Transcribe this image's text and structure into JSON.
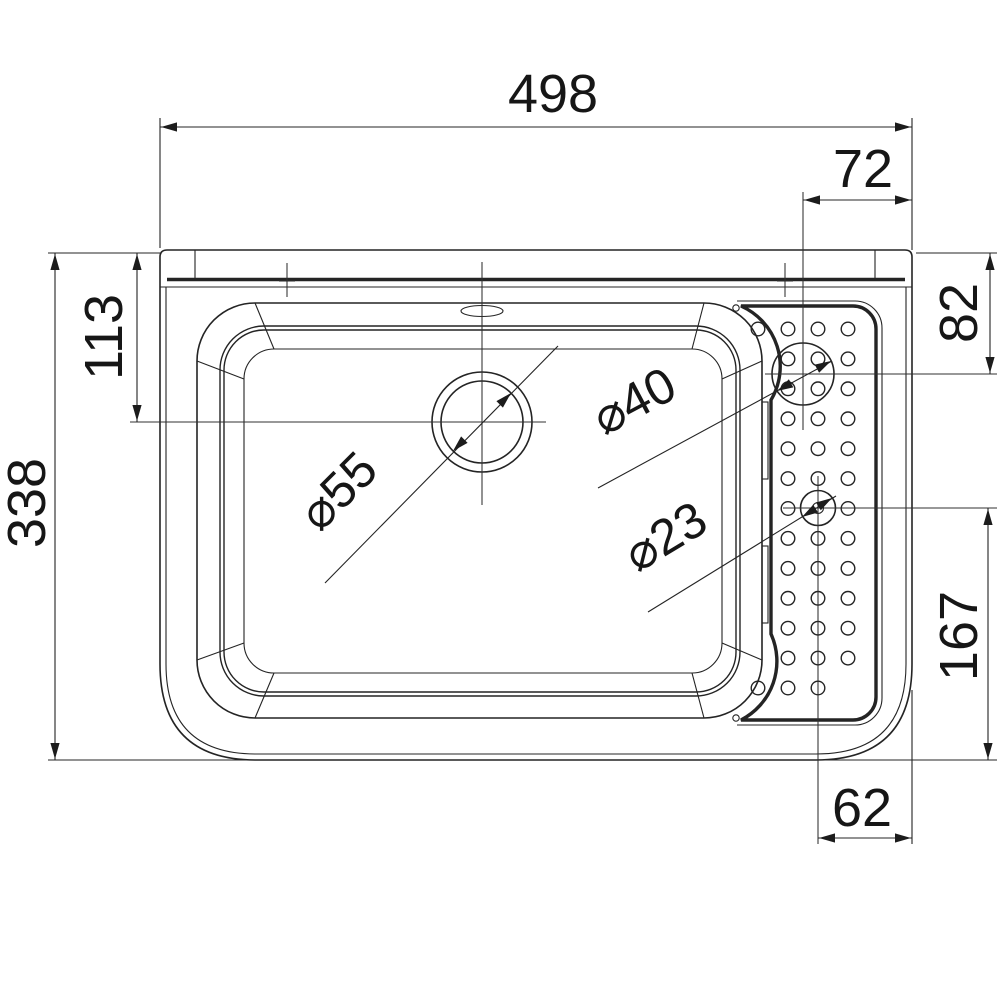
{
  "document": {
    "type": "technical-drawing",
    "subject": "sink-top-view",
    "units": "mm"
  },
  "page": {
    "background": "#ffffff",
    "ink": "#242424",
    "text_color": "#161616"
  },
  "dimensions": [
    {
      "label": "498",
      "value": 498,
      "axis": "h",
      "line": {
        "x1": 160,
        "x2": 912,
        "y": 127
      },
      "text": {
        "x": 553,
        "y": 112,
        "rot": 0
      },
      "ext": [
        [
          160,
          118,
          160,
          248
        ],
        [
          912,
          118,
          912,
          250
        ]
      ]
    },
    {
      "label": "72",
      "value": 72,
      "axis": "h",
      "line": {
        "x1": 803,
        "x2": 912,
        "y": 200
      },
      "text": {
        "x": 863,
        "y": 187,
        "rot": 0
      },
      "ext": []
    },
    {
      "label": "82",
      "value": 82,
      "axis": "v",
      "line": {
        "x": 990,
        "y1": 253,
        "y2": 374
      },
      "text": {
        "x": 977,
        "y": 313,
        "rot": -90
      },
      "ext": [
        [
          916,
          253,
          997,
          253
        ]
      ]
    },
    {
      "label": "113",
      "value": 113,
      "axis": "v",
      "line": {
        "x": 137,
        "y1": 253,
        "y2": 422
      },
      "text": {
        "x": 122,
        "y": 337,
        "rot": -90
      },
      "ext": [
        [
          48,
          253,
          160,
          253
        ]
      ]
    },
    {
      "label": "338",
      "value": 338,
      "axis": "v",
      "line": {
        "x": 55,
        "y1": 253,
        "y2": 760
      },
      "text": {
        "x": 45,
        "y": 503,
        "rot": -90
      },
      "ext": [
        [
          48,
          760,
          258,
          760
        ]
      ]
    },
    {
      "label": "167",
      "value": 167,
      "axis": "v",
      "line": {
        "x": 988,
        "y1": 508,
        "y2": 760
      },
      "text": {
        "x": 977,
        "y": 636,
        "rot": -90
      },
      "ext": [
        [
          820,
          760,
          997,
          760
        ]
      ]
    },
    {
      "label": "62",
      "value": 62,
      "axis": "h",
      "line": {
        "x1": 818,
        "x2": 912,
        "y": 838
      },
      "text": {
        "x": 862,
        "y": 826,
        "rot": 0
      },
      "ext": [
        [
          912,
          690,
          912,
          844
        ]
      ]
    }
  ],
  "leaders": [
    {
      "label": "⌀55",
      "value": 55,
      "line": [
        325,
        583,
        558,
        346
      ],
      "tips": [
        [
          453,
          451,
          135
        ],
        [
          511,
          393,
          -45
        ]
      ],
      "text": {
        "x": 350,
        "y": 503,
        "rot": -45
      }
    },
    {
      "label": "⌀40",
      "value": 40,
      "line": [
        598,
        488,
        832,
        361
      ],
      "tips": [
        [
          777,
          391,
          151.5
        ],
        [
          831,
          361,
          -28.5
        ]
      ],
      "text": {
        "x": 642,
        "y": 416,
        "rot": -28
      }
    },
    {
      "label": "⌀23",
      "value": 23,
      "line": [
        648,
        612,
        836,
        496
      ],
      "tips": [
        [
          802,
          517,
          148.3
        ],
        [
          832,
          498,
          -31.7
        ]
      ],
      "text": {
        "x": 674,
        "y": 551,
        "rot": -31
      }
    }
  ],
  "centerlines": [
    [
      482,
      262,
      482,
      505
    ],
    [
      130,
      422,
      546,
      422
    ],
    [
      803,
      192,
      803,
      430
    ],
    [
      765,
      374,
      997,
      374
    ],
    [
      818,
      476,
      818,
      844
    ],
    [
      783,
      508,
      997,
      508
    ]
  ],
  "band_ticks": {
    "verticals": [
      [
        287,
        263,
        287,
        297
      ],
      [
        785,
        263,
        785,
        297
      ]
    ],
    "dashes": [
      [
        279,
        281,
        295,
        281
      ],
      [
        777,
        281,
        793,
        281
      ]
    ]
  },
  "holes": {
    "columns": [
      758,
      788,
      818,
      848
    ],
    "row_start": 329,
    "row_step": 29.92,
    "row_count": 13,
    "radius": 6.8,
    "col_include_only": {
      "0": [
        0,
        12
      ]
    },
    "omit": [
      [
        3,
        12
      ],
      [
        2,
        6
      ]
    ]
  }
}
